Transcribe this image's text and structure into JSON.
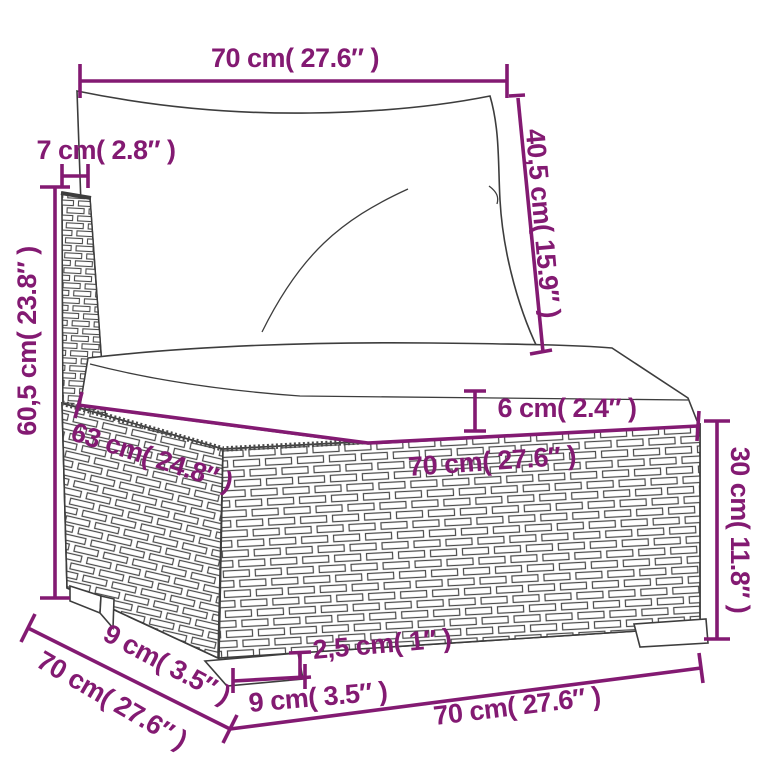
{
  "accent_color": "#831a72",
  "line_color": "#3d3d3d",
  "dimensions": {
    "back_width": "70 cm( 27.6″ )",
    "back_thickness": "7 cm( 2.8″ )",
    "total_height": "60,5 cm( 23.8″ )",
    "back_cushion_height": "40,5 cm( 15.9″ )",
    "seat_cushion_thickness": "6 cm( 2.4″ )",
    "seat_depth": "63 cm( 24.8″ )",
    "seat_width": "70 cm( 27.6″ )",
    "base_height": "30 cm( 11.8″ )",
    "corner_foot_depth": "9 cm( 3.5″ )",
    "total_depth": "70 cm( 27.6″ )",
    "foot_width": "9 cm( 3.5″ )",
    "foot_height": "2,5 cm( 1″ )",
    "total_width": "70 cm( 27.6″ )"
  }
}
